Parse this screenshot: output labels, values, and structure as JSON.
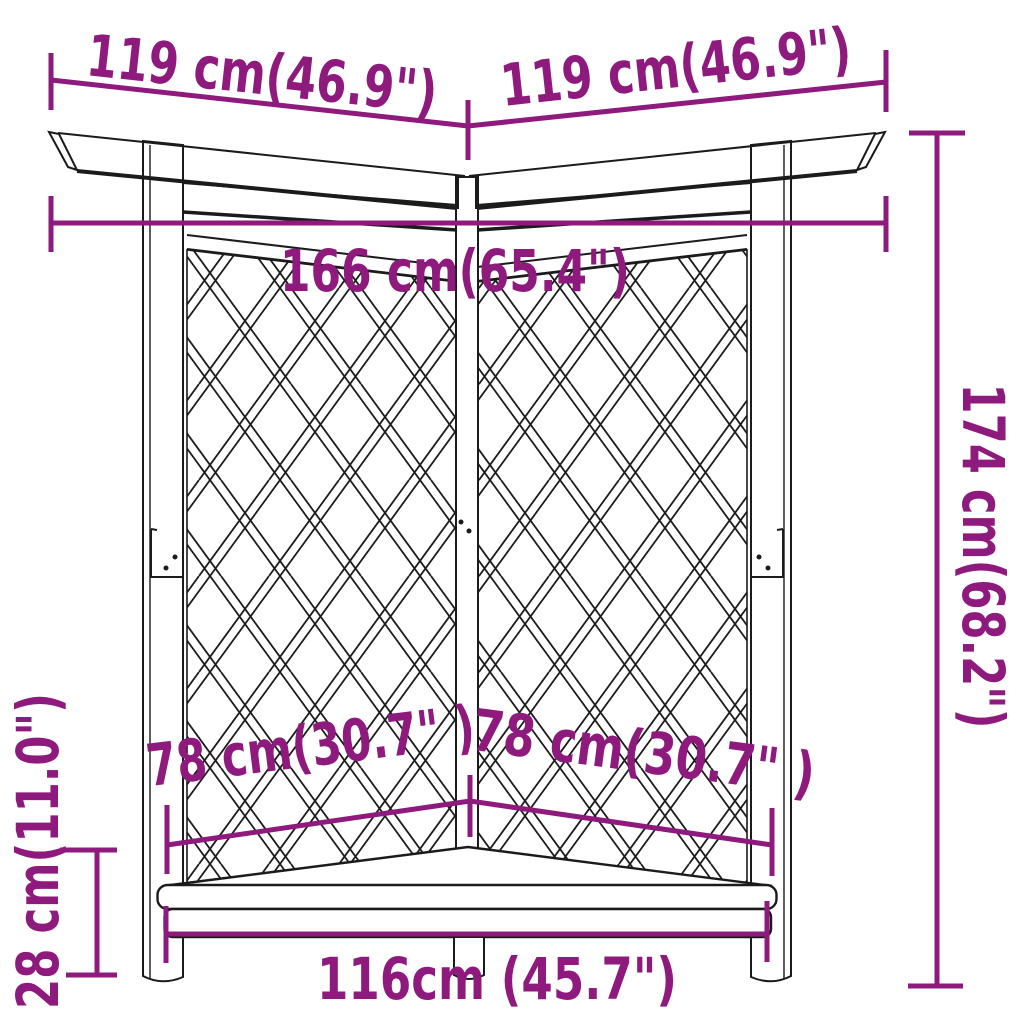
{
  "figure": {
    "type": "product-dimension-diagram",
    "subject": "corner pergola with trellis panels and bench"
  },
  "colors": {
    "dimension_annotation": "#8F1A7D",
    "line_art": "#1b1b1b",
    "background": "#ffffff"
  },
  "dimensions": {
    "roof_left_width": "119 cm(46.9\")",
    "roof_right_width": "119 cm(46.9\")",
    "overall_width": "166 cm(65.4\")",
    "overall_height": "174 cm(68.2\")",
    "seat_height": "28 cm(11.0\")",
    "seat_left_depth": "78 cm(30.7\" )",
    "seat_right_depth": "78 cm(30.7\" )",
    "bench_width": "116cm (45.7\")"
  }
}
